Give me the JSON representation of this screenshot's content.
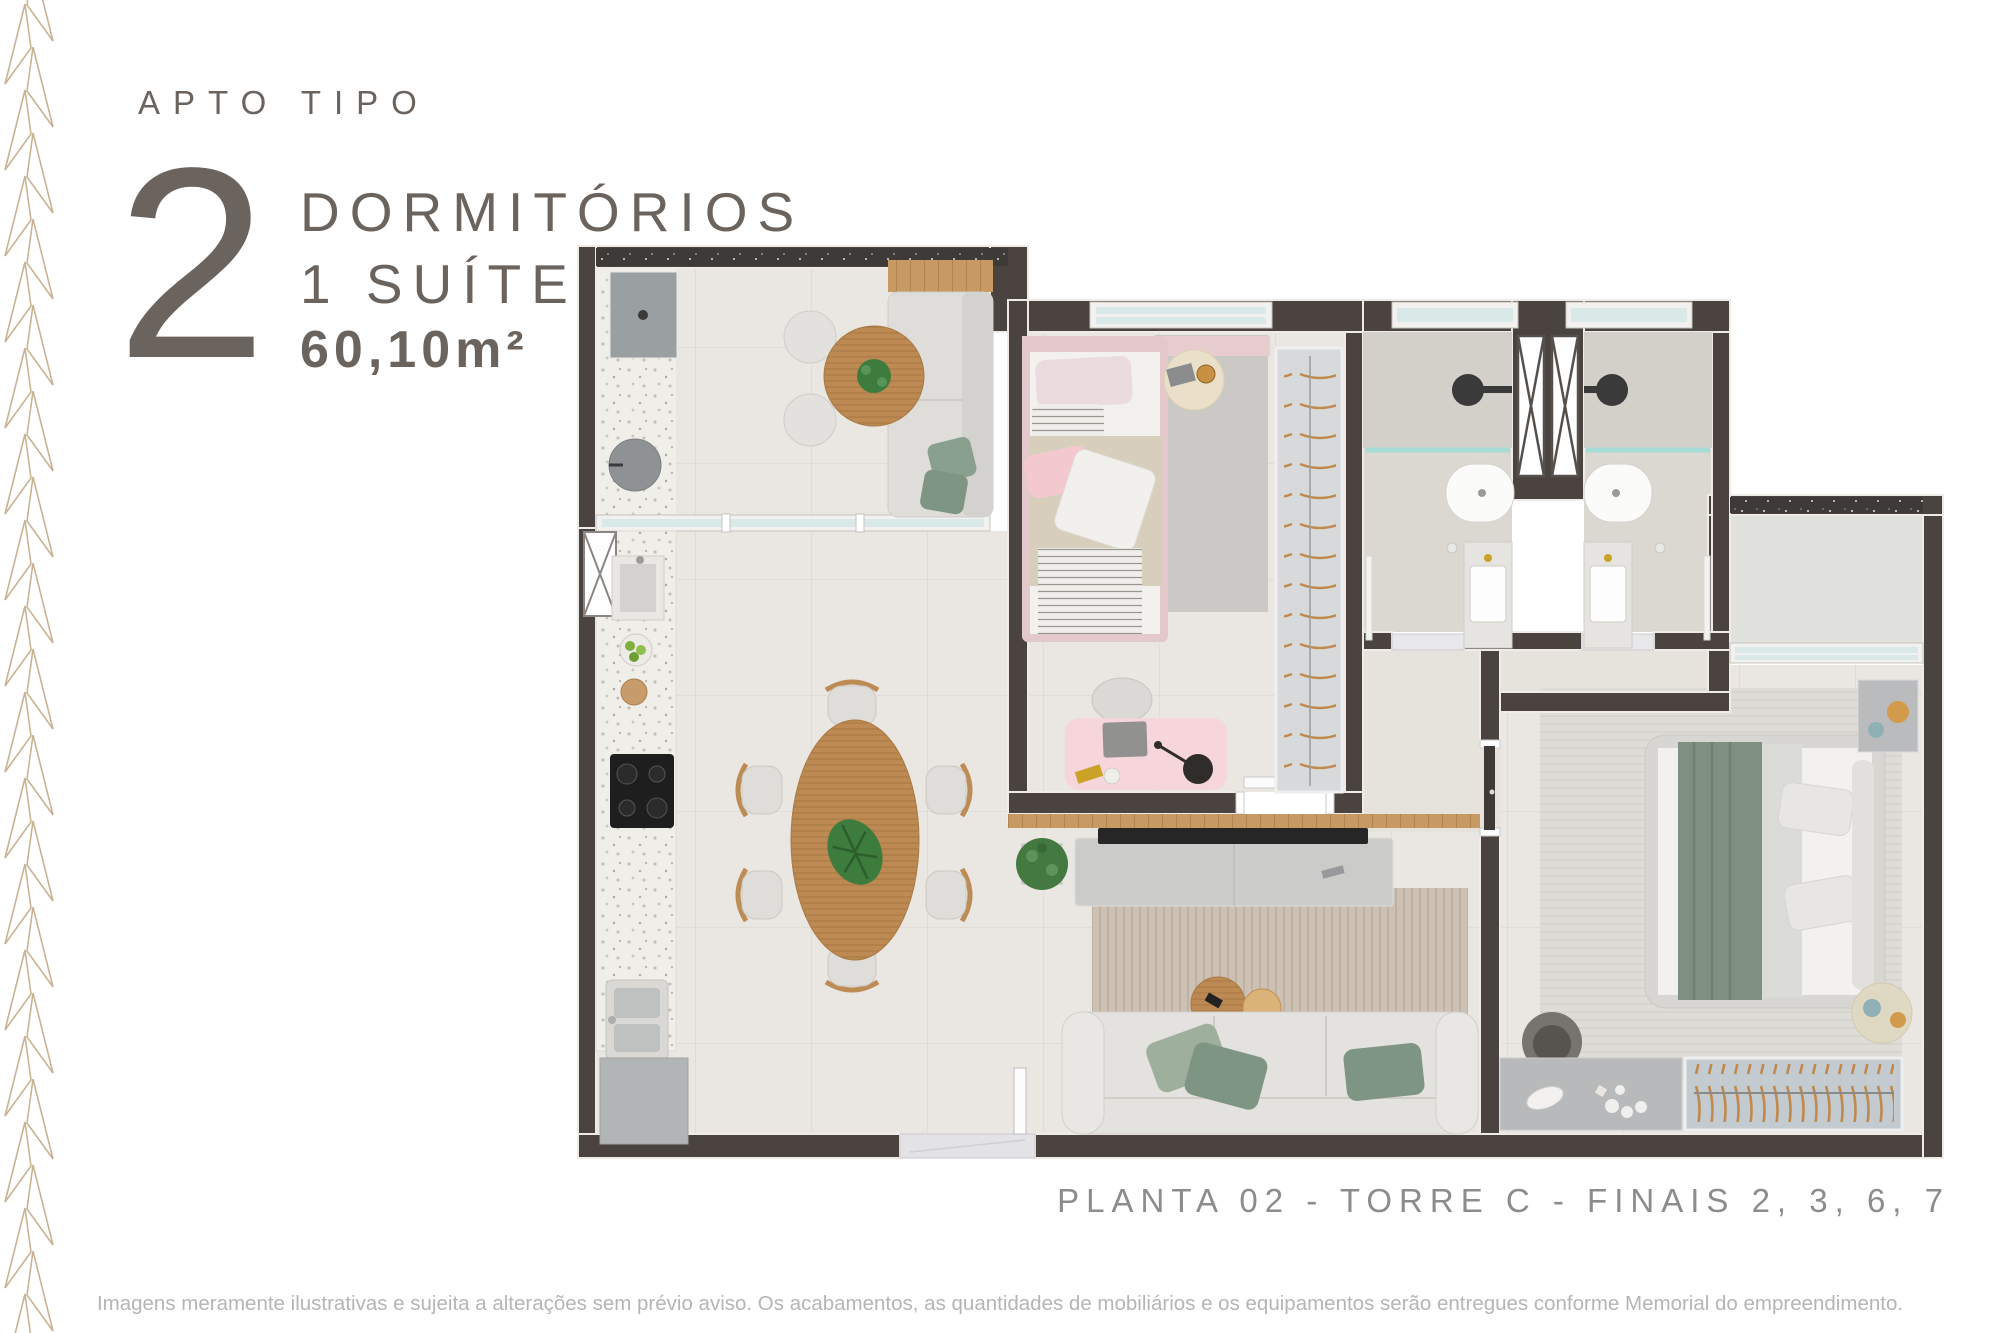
{
  "header": {
    "eyebrow": "APTO TIPO",
    "number": "2",
    "dorms_label": "DORMITÓRIOS",
    "suite_label": "1 SUÍTE",
    "area_label": "60,10m²"
  },
  "plan": {
    "caption": "PLANTA 02 - TORRE C - FINAIS 2, 3, 6, 7",
    "rooms": [
      "varanda-gourmet",
      "cozinha",
      "sala-de-jantar",
      "sala-de-estar",
      "dormitorio",
      "suite",
      "banheiro-1",
      "banheiro-2",
      "corredor",
      "area-tecnica"
    ]
  },
  "footer": {
    "disclaimer": "Imagens meramente ilustrativas e sujeita a alterações sem prévio aviso. Os acabamentos, as quantidades de mobiliários e os equipamentos serão entregues conforme Memorial do empreendimento."
  },
  "colors": {
    "title_text": "#6B635D",
    "caption_text": "#8C8C8C",
    "disclaimer_text": "#B5B5B5",
    "pattern_accent": "#C9B394",
    "wall": "#4A433F",
    "floor": "#EAE7E1",
    "wood": "#BC8A52",
    "greenery": "#447A42",
    "blush_pink": "#F3C9CF",
    "sage_green": "#7F9583",
    "glass": "#D9E9E7"
  }
}
